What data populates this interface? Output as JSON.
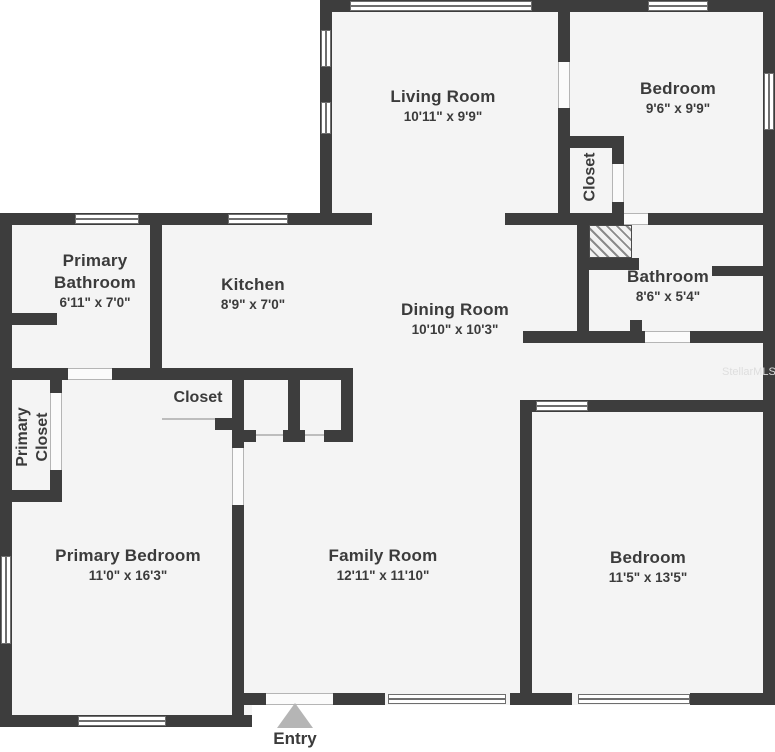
{
  "plan": {
    "rooms": [
      {
        "name": "Living Room",
        "dims": "10'11\" x 9'9\""
      },
      {
        "name": "Bedroom",
        "dims": "9'6\" x 9'9\""
      },
      {
        "name": "Closet",
        "dims": ""
      },
      {
        "name": "Bathroom",
        "dims": "8'6\" x 5'4\""
      },
      {
        "name": "Primary Bathroom",
        "dims": "6'11\" x 7'0\""
      },
      {
        "name": "Kitchen",
        "dims": "8'9\" x 7'0\""
      },
      {
        "name": "Dining Room",
        "dims": "10'10\" x 10'3\""
      },
      {
        "name": "Closet",
        "dims": ""
      },
      {
        "name": "Primary Closet",
        "dims": ""
      },
      {
        "name": "Primary Bedroom",
        "dims": "11'0\" x 16'3\""
      },
      {
        "name": "Family Room",
        "dims": "12'11\" x 11'10\""
      },
      {
        "name": "Bedroom",
        "dims": "11'5\" x 13'5\""
      }
    ],
    "entry_label": "Entry",
    "watermark": "StellarMLS",
    "colors": {
      "wall": "#3d3d3d",
      "room_fill": "#f4f4f4",
      "text": "#3b3b3b",
      "entry_arrow": "#b5b5b5",
      "window_line": "#6e6e6e"
    }
  }
}
